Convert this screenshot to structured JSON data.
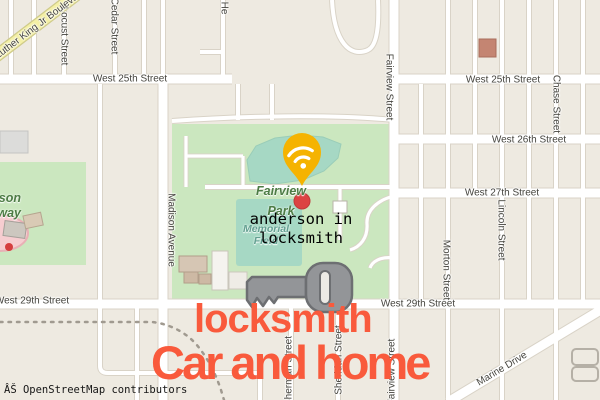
{
  "map": {
    "attribution": "ÂŠ OpenStreetMap contributors",
    "streets": [
      {
        "id": "w25-left",
        "text": "West 25th Street"
      },
      {
        "id": "w25-right",
        "text": "West 25th Street"
      },
      {
        "id": "w26",
        "text": "West 26th Street"
      },
      {
        "id": "w27",
        "text": "West 27th Street"
      },
      {
        "id": "w29-left",
        "text": "West 29th Street"
      },
      {
        "id": "w29-mid",
        "text": "West 29th Street"
      },
      {
        "id": "locust",
        "text": "Locust Street"
      },
      {
        "id": "cedar",
        "text": "Cedar Street"
      },
      {
        "id": "henry",
        "text": "He"
      },
      {
        "id": "fairview-top",
        "text": "Fairview Street"
      },
      {
        "id": "chase",
        "text": "Chase Street"
      },
      {
        "id": "lincoln",
        "text": "Lincoln Street"
      },
      {
        "id": "morton",
        "text": "Morton Street"
      },
      {
        "id": "madison",
        "text": "Madison Avenue"
      },
      {
        "id": "fairview-bottom",
        "text": "Fairview Street"
      },
      {
        "id": "sherman",
        "text": "Sherman Street"
      },
      {
        "id": "sheridan",
        "text": "Sheridan Street"
      },
      {
        "id": "mlk",
        "text": "Martin Luther King Jr Boulevard"
      },
      {
        "id": "marine",
        "text": "Marine Drive"
      }
    ],
    "areas": {
      "park_line1": "Fairview",
      "park_line2": "Park",
      "field_line1": "Memorial",
      "field_line2": "Field",
      "speedway_line1": "Anderson",
      "speedway_line2": "Speedway"
    },
    "colors": {
      "background": "#eeeae1",
      "park_green": "#cbe7bf",
      "field_teal": "#a6d8c4",
      "road_yellow": "#f4f0a5",
      "pin_amber": "#f5b301",
      "poi_red": "#dc4343",
      "key_gray": "#939598",
      "brand_red": "#f95a3c"
    }
  },
  "overlay": {
    "query_line1": "anderson in",
    "query_line2": "locksmith",
    "brand_line1": "locksmith",
    "brand_line2": "Car and home"
  }
}
